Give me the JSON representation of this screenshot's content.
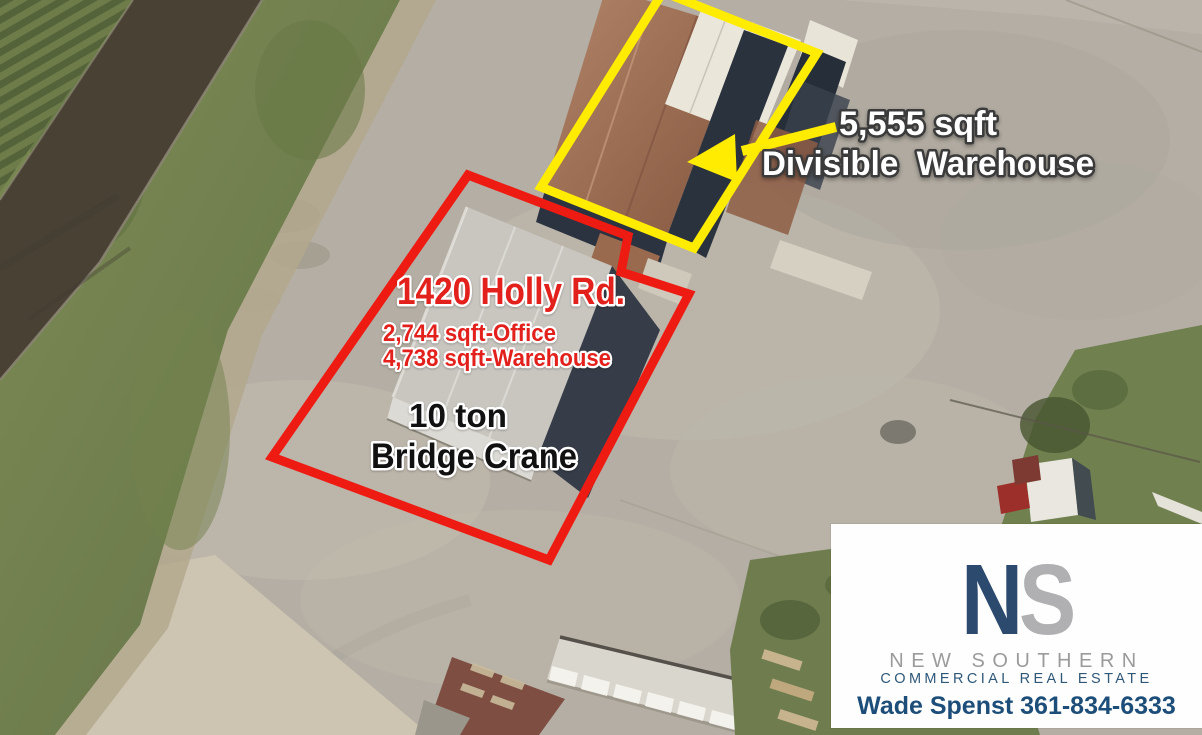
{
  "annotations": {
    "warehouse_callout": {
      "sqft": "5,555 sqft",
      "label": "Divisible  Warehouse"
    },
    "property_callout": {
      "address": "1420 Holly Rd.",
      "office_sqft": "2,744 sqft-Office",
      "warehouse_sqft": "4,738 sqft-Warehouse"
    },
    "crane_callout": {
      "capacity": "10 ton",
      "label": "Bridge Crane"
    },
    "colors": {
      "highlight_yellow": "#ffec00",
      "outline_red": "#ee1b13",
      "text_red": "#e3211c",
      "text_white": "#ffffff",
      "text_black": "#111111"
    }
  },
  "branding": {
    "monogram": {
      "n": "N",
      "s": "S"
    },
    "company_name": "NEW SOUTHERN",
    "company_subtitle": "COMMERCIAL REAL ESTATE",
    "contact": "Wade Spenst 361-834-6333",
    "colors": {
      "navy": "#2c4a6e",
      "gray": "#b0b0b3",
      "contact_navy": "#1d4e79"
    }
  }
}
